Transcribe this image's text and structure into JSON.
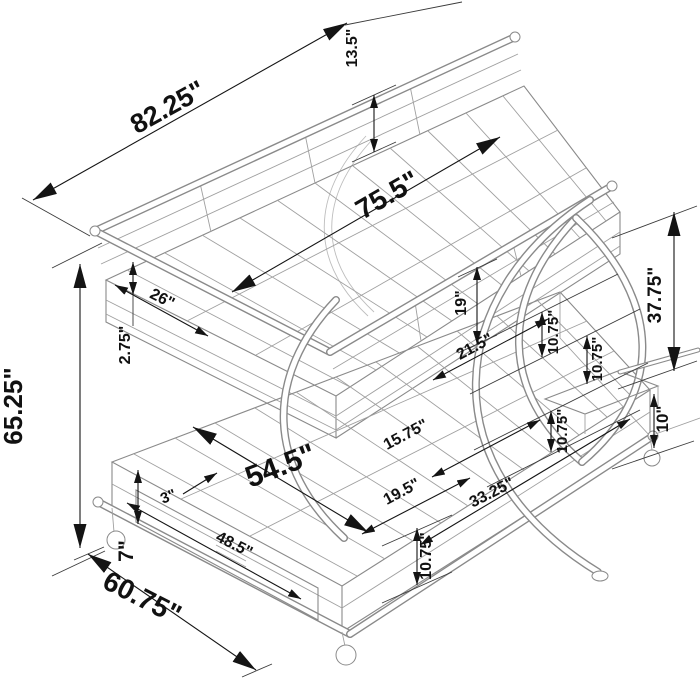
{
  "diagram": {
    "dimensions": [
      {
        "name": "overall-length",
        "label": "82.25\""
      },
      {
        "name": "guardrail-height",
        "label": "13.5\""
      },
      {
        "name": "upper-bed-length",
        "label": "75.5\""
      },
      {
        "name": "end-panel-span",
        "label": "26\""
      },
      {
        "name": "rail-height",
        "label": "2.75\""
      },
      {
        "name": "overall-height",
        "label": "65.25\""
      },
      {
        "name": "bunk-clearance",
        "label": "19\""
      },
      {
        "name": "right-end-height",
        "label": "37.75\""
      },
      {
        "name": "leg-gap-upper",
        "label": "10.75\""
      },
      {
        "name": "leg-gap-middle",
        "label": "10.75\""
      },
      {
        "name": "leg-gap-lower",
        "label": "10.75\""
      },
      {
        "name": "shelf-height",
        "label": "10\""
      },
      {
        "name": "leg-offset",
        "label": "21.5\""
      },
      {
        "name": "mid-span",
        "label": "15.75\""
      },
      {
        "name": "front-span",
        "label": "19.5\""
      },
      {
        "name": "end-span",
        "label": "33.25\""
      },
      {
        "name": "base-height",
        "label": "10.75\""
      },
      {
        "name": "lower-bed-span",
        "label": "54.5\""
      },
      {
        "name": "drawer-inset",
        "label": "3\""
      },
      {
        "name": "drawer-width",
        "label": "48.5\""
      },
      {
        "name": "drawer-height",
        "label": "7\""
      },
      {
        "name": "overall-width",
        "label": "60.75\""
      }
    ]
  }
}
